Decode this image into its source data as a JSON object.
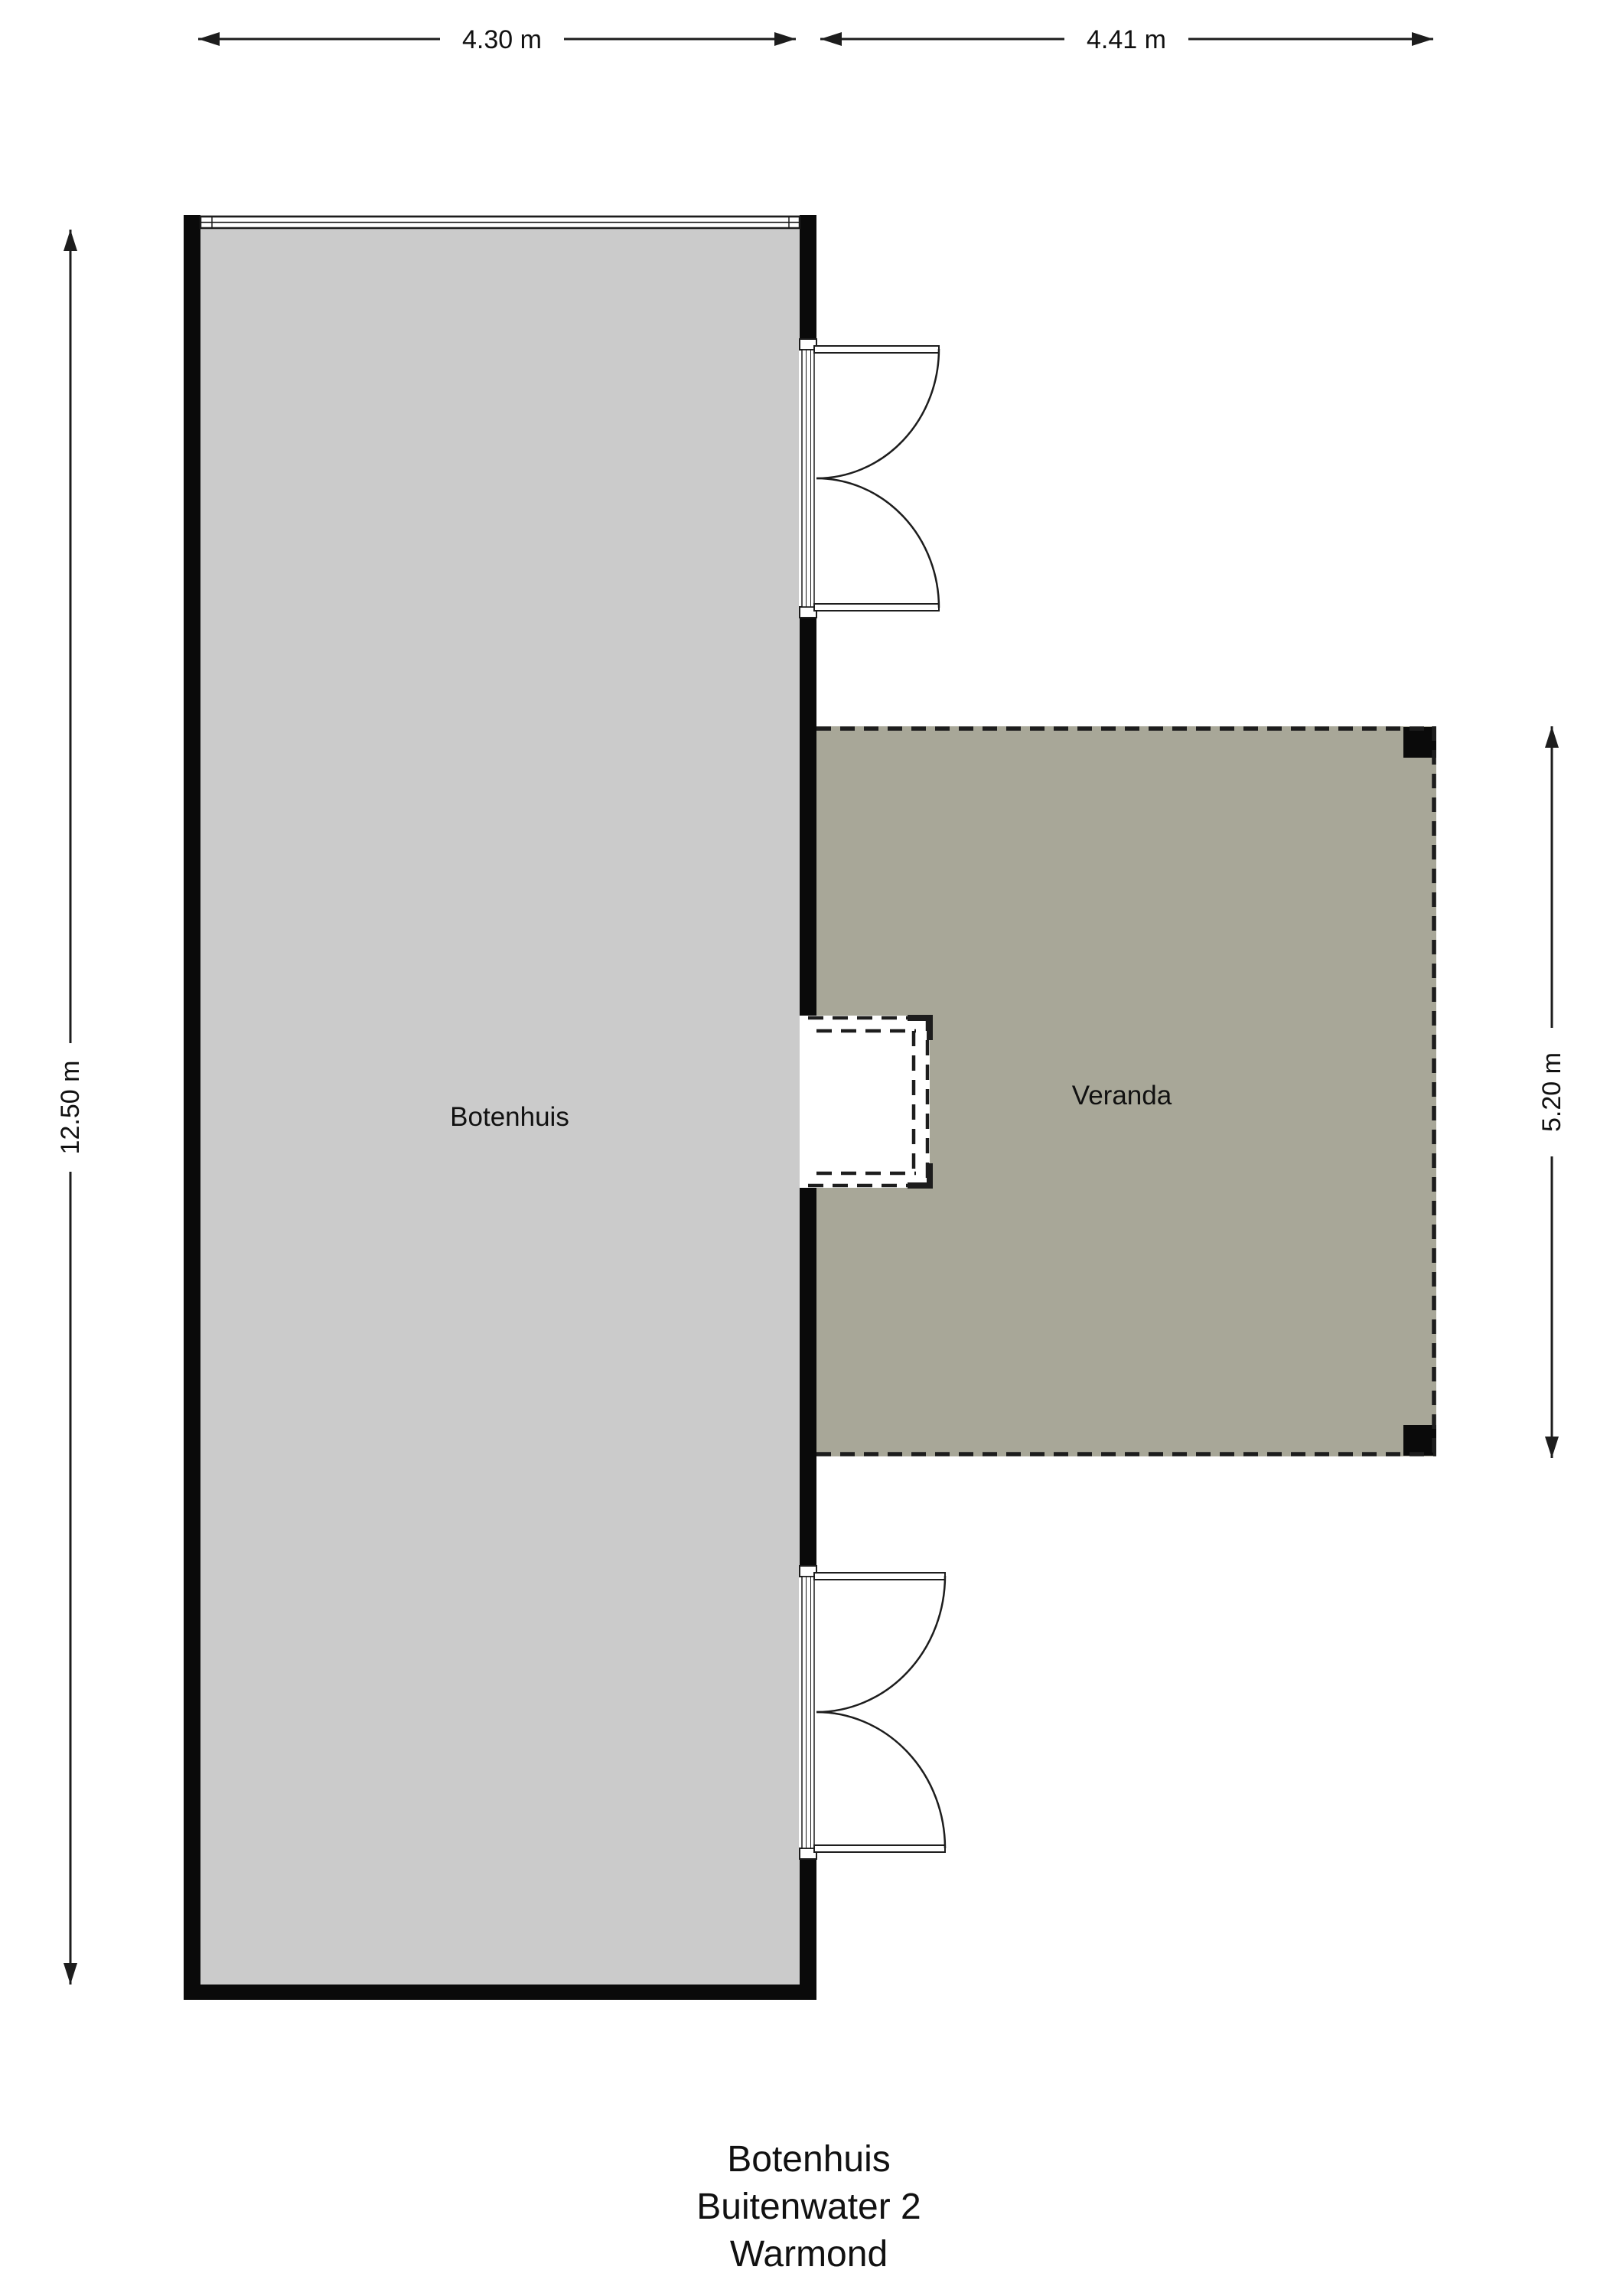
{
  "plan": {
    "dimensions": {
      "boathouse_width": "4.30 m",
      "veranda_width": "4.41 m",
      "boathouse_length": "12.50 m",
      "veranda_length": "5.20 m"
    },
    "rooms": {
      "boathouse": "Botenhuis",
      "veranda": "Veranda"
    },
    "title_block": {
      "line1": "Botenhuis",
      "line2": "Buitenwater 2",
      "line3": "Warmond"
    },
    "colors": {
      "boathouse_fill": "#cbcbcb",
      "veranda_fill": "#a8a798",
      "wall": "#0a0a0a",
      "line": "#1d1d1d",
      "text": "#111111",
      "paper": "#ffffff"
    }
  }
}
